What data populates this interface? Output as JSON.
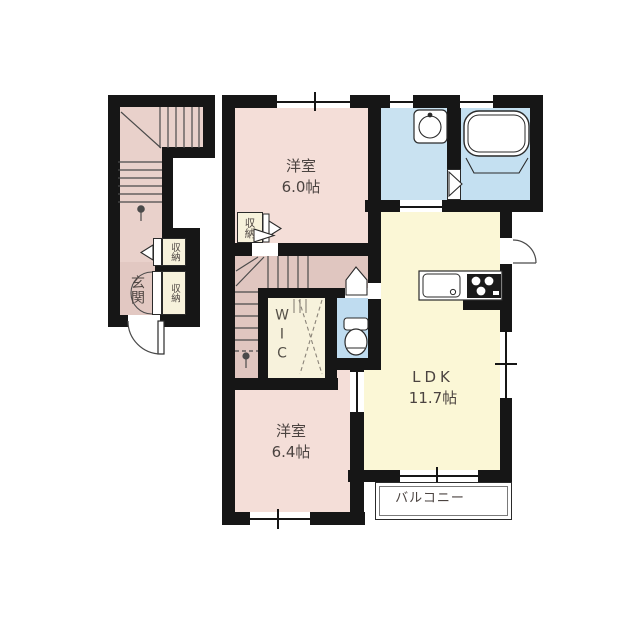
{
  "plan": {
    "type": "apartment-floor-plan",
    "rooms": {
      "bedroom1": {
        "name": "洋室",
        "size": "6.0帖"
      },
      "bedroom2": {
        "name": "洋室",
        "size": "6.4帖"
      },
      "ldk": {
        "name": "LDK",
        "size": "11.7帖"
      },
      "wic": {
        "name": "WIC"
      },
      "entrance": {
        "name": "玄関"
      },
      "balcony": {
        "name": "バルコニー"
      },
      "closet_bedroom1": {
        "name": "収納"
      },
      "closet_stairhall": {
        "name": "収納"
      },
      "closet_entrance": {
        "name": "収納"
      }
    },
    "fixtures": [
      "staircase-external",
      "staircase-internal",
      "bathtub",
      "vanity-sink",
      "toilet",
      "kitchen-sink",
      "gas-stove",
      "entrance-door",
      "balcony-window"
    ],
    "colors": {
      "wall": "#161616",
      "room_pink": "#f4ded8",
      "hall_pink": "#e0c6c0",
      "stair_pink": "#e9d1cb",
      "ldk_cream": "#fbf7d6",
      "closet_cream": "#f7f2dc",
      "water_blue": "#c9e2f1",
      "toilet_blue": "#bfdcf0",
      "label": "#4b4340"
    }
  }
}
